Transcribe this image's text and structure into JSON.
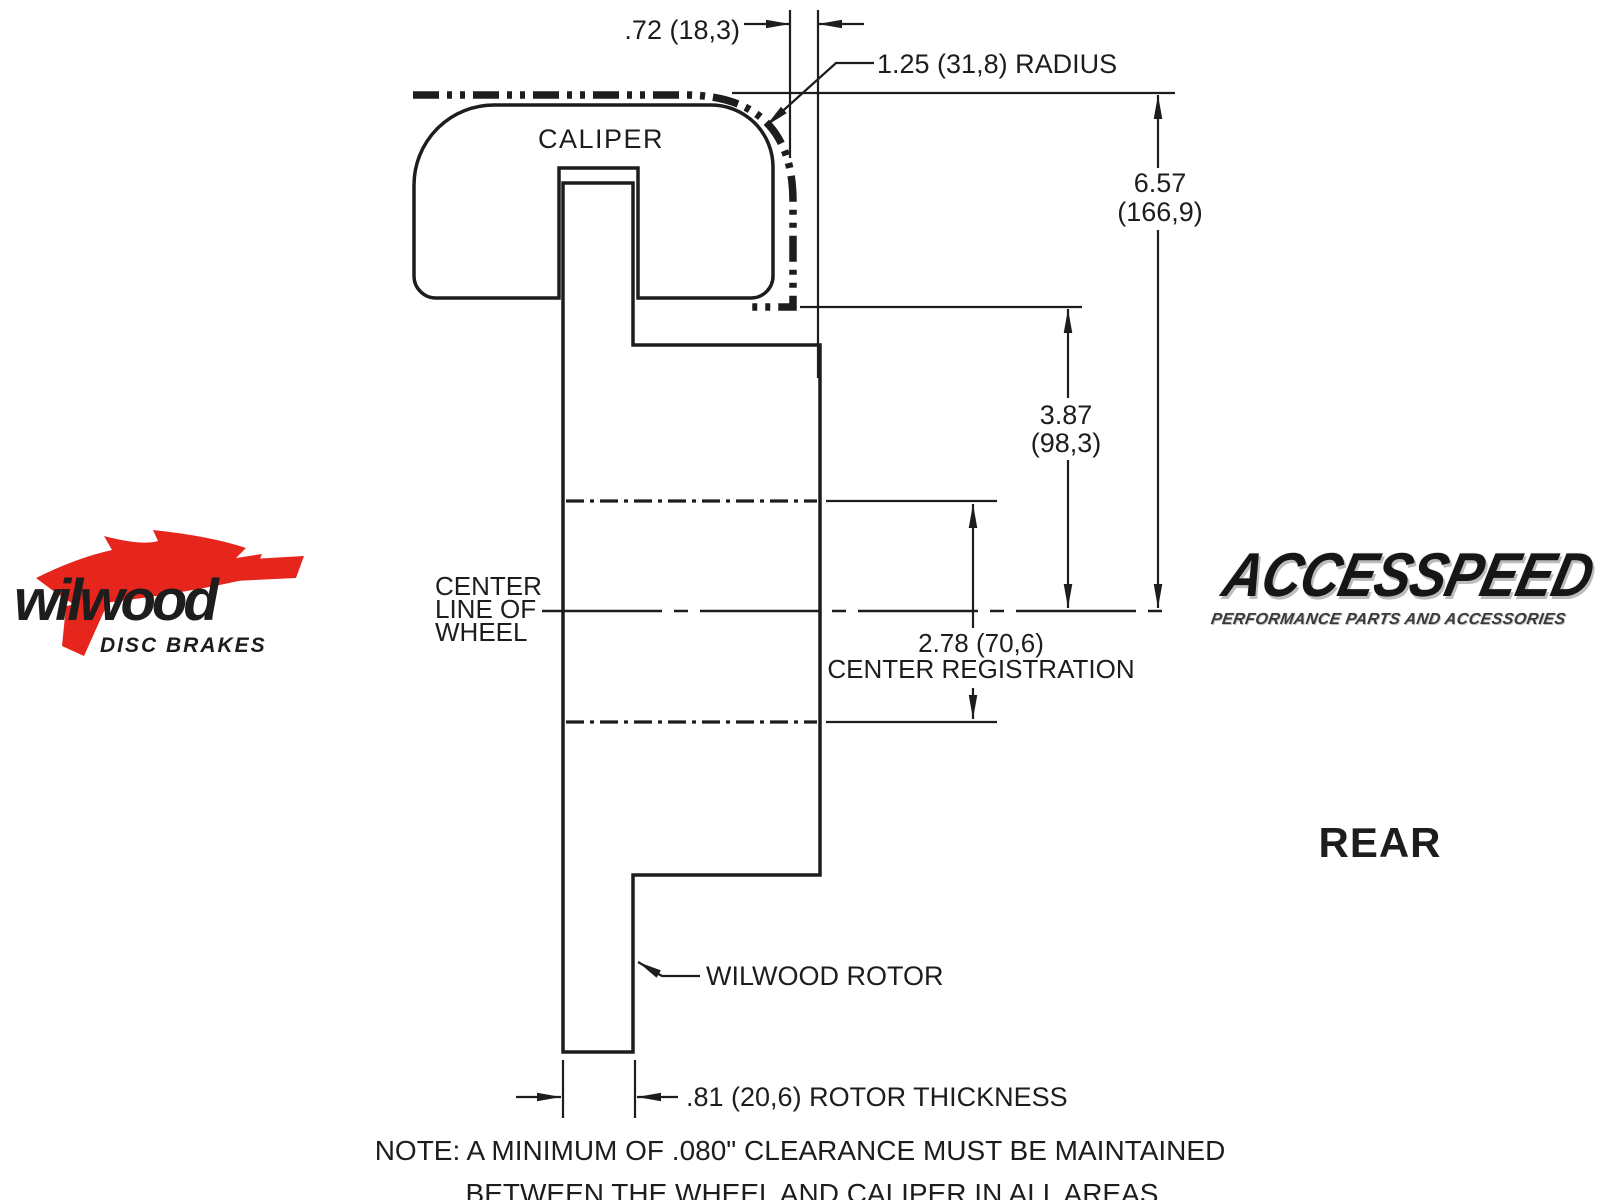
{
  "drawing": {
    "caliper_label": "CALIPER",
    "rotor_leader_label": "WILWOOD ROTOR",
    "view_label": "REAR",
    "centerline_label": {
      "line1": "CENTER",
      "line2": "LINE OF",
      "line3": "WHEEL"
    },
    "dimensions": {
      "top_offset": ".72 (18,3)",
      "corner_radius": "1.25 (31,8) RADIUS",
      "overall_height": {
        "in": "6.57",
        "mm": "(166,9)"
      },
      "mount_height": {
        "in": "3.87",
        "mm": "(98,3)"
      },
      "center_registration": {
        "value": "2.78 (70,6)",
        "label": "CENTER REGISTRATION"
      },
      "rotor_thickness": ".81 (20,6) ROTOR THICKNESS"
    },
    "note": {
      "line1": "NOTE: A MINIMUM OF .080\" CLEARANCE MUST BE MAINTAINED",
      "line2": "BETWEEN THE WHEEL AND CALIPER IN ALL AREAS"
    }
  },
  "logos": {
    "wilwood": {
      "name": "wilwood",
      "tagline": "DISC BRAKES",
      "brand_red": "#e6261d"
    },
    "accesspeed": {
      "name": "ACCESSPEED",
      "tagline": "PERFORMANCE PARTS AND ACCESSORIES"
    }
  },
  "colors": {
    "background": "#ffffff",
    "caliper_fill": "#e9ebec",
    "rotor_fill": "#c7cacc",
    "line": "#1d1d1d"
  }
}
